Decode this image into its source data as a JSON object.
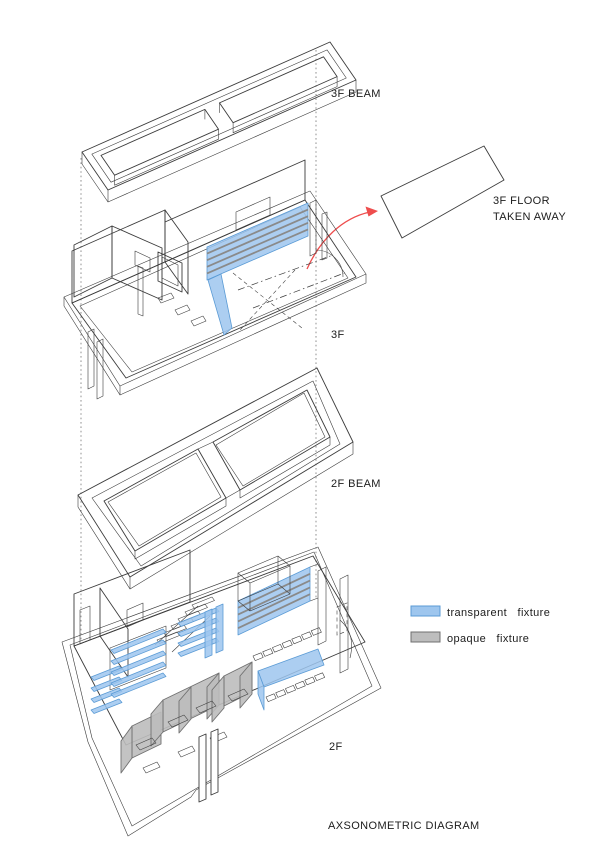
{
  "page": {
    "title": "AXSONOMETRIC DIAGRAM",
    "background": "#ffffff"
  },
  "labels": {
    "beam3f": "3F BEAM",
    "taken_line1": "3F FLOOR",
    "taken_line2": "TAKEN AWAY",
    "floor3f": "3F",
    "beam2f": "2F BEAM",
    "floor2f": "2F",
    "diagram_title": "AXSONOMETRIC DIAGRAM"
  },
  "legend": {
    "items": [
      {
        "label": "transparent fixture",
        "color": "#9ec6ee"
      },
      {
        "label": "opaque fixture",
        "color": "#bdbdbd"
      }
    ]
  },
  "colors": {
    "line": "#3c3c3c",
    "transparent_fixture": "#9ec6ee",
    "transparent_fixture_edge": "#5b9bd5",
    "opaque_fixture": "#bdbdbd",
    "opaque_fixture_edge": "#707070",
    "arrow_red": "#ee4d4d",
    "shelf_line": "#8a8a8a",
    "construction_line": "#9a9a9a"
  }
}
